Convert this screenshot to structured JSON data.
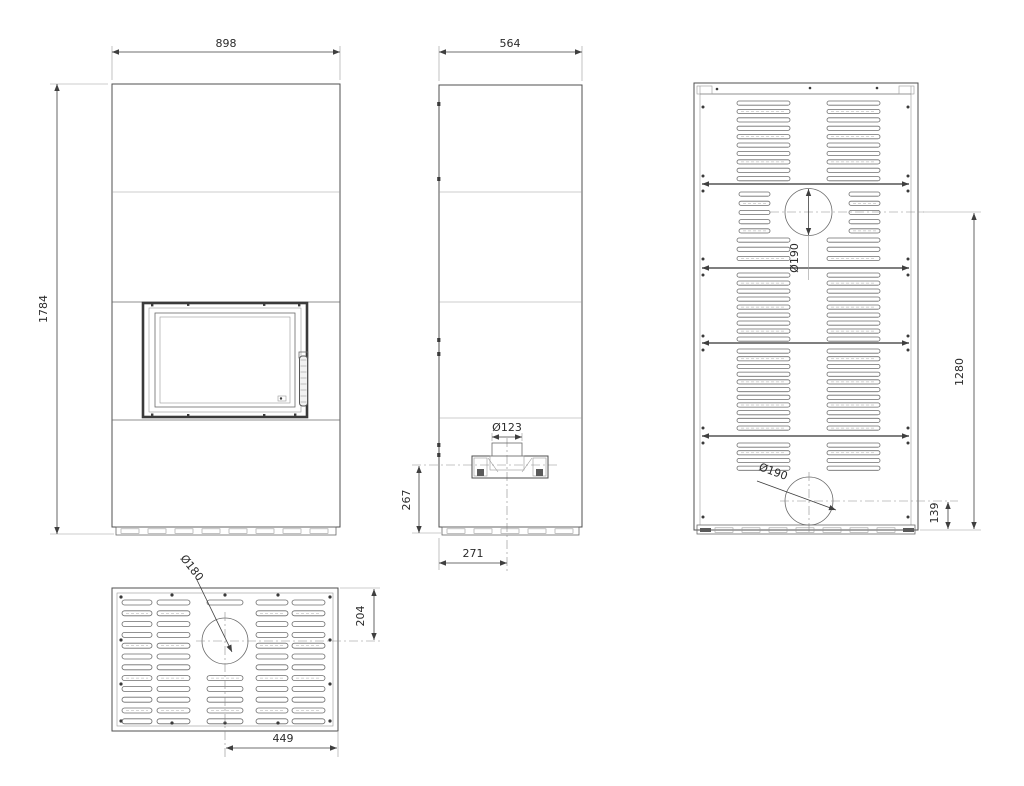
{
  "drawing": {
    "type": "technical-drawing",
    "subject": "fireplace-stove-dimension-drawing",
    "front": {
      "width": "898",
      "height": "1784"
    },
    "side": {
      "width": "564",
      "intake_diameter": "Ø123",
      "intake_center_height": "267",
      "intake_center_offset": "271"
    },
    "back": {
      "top_outlet_diameter": "Ø190",
      "bottom_outlet_diameter": "Ø190",
      "outlet_span": "1280",
      "bottom_outlet_height": "139"
    },
    "top": {
      "outlet_diameter": "Ø180",
      "outlet_front_offset": "204",
      "outlet_side_offset": "449"
    },
    "colors": {
      "line": "#4f4f4f",
      "dim": "#3f3f3f",
      "background": "#ffffff"
    }
  }
}
